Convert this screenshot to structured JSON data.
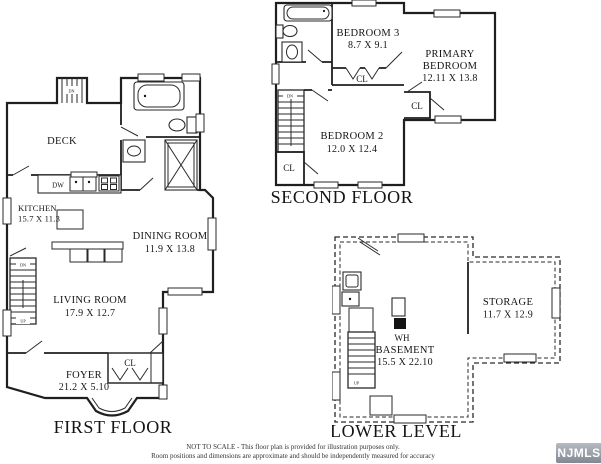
{
  "first_floor": {
    "title": "FIRST FLOOR",
    "rooms": {
      "deck": {
        "name": "DECK"
      },
      "kitchen": {
        "name": "KITCHEN",
        "dims": "15.7 X 11.3"
      },
      "dining_room": {
        "name": "DINING ROOM",
        "dims": "11.9 X 13.8"
      },
      "living_room": {
        "name": "LIVING ROOM",
        "dims": "17.9 X 12.7"
      },
      "foyer": {
        "name": "FOYER",
        "dims": "21.2 X 5.10"
      }
    },
    "labels": {
      "closet": "CL",
      "dishwasher": "DW",
      "deck_stairs_down": "DN",
      "stairs_down": "DN",
      "stairs_up": "UP"
    }
  },
  "second_floor": {
    "title": "SECOND FLOOR",
    "rooms": {
      "bedroom_3": {
        "name": "BEDROOM 3",
        "dims": "8.7 X 9.1"
      },
      "primary_bedroom": {
        "name_line1": "PRIMARY",
        "name_line2": "BEDROOM",
        "dims": "12.11 X 13.8"
      },
      "bedroom_2": {
        "name": "BEDROOM 2",
        "dims": "12.0 X 12.4"
      }
    },
    "labels": {
      "closet_hall": "CL",
      "closet_primary": "CL",
      "closet_corner": "CL",
      "stairs_down": "DN"
    }
  },
  "lower_level": {
    "title": "LOWER LEVEL",
    "rooms": {
      "basement": {
        "name": "BASEMENT",
        "dims": "15.5 X 22.10"
      },
      "storage": {
        "name": "STORAGE",
        "dims": "11.7 X 12.9"
      }
    },
    "labels": {
      "water_heater": "WH",
      "stairs_up": "UP"
    }
  },
  "footer": {
    "disclaimer_line1": "NOT TO SCALE - This floor plan is provided for illustration purposes only.",
    "disclaimer_line2": "Room positions and dimensions are approximate and should be independently measured for accuracy"
  },
  "watermark": {
    "label": "NJMLS"
  }
}
